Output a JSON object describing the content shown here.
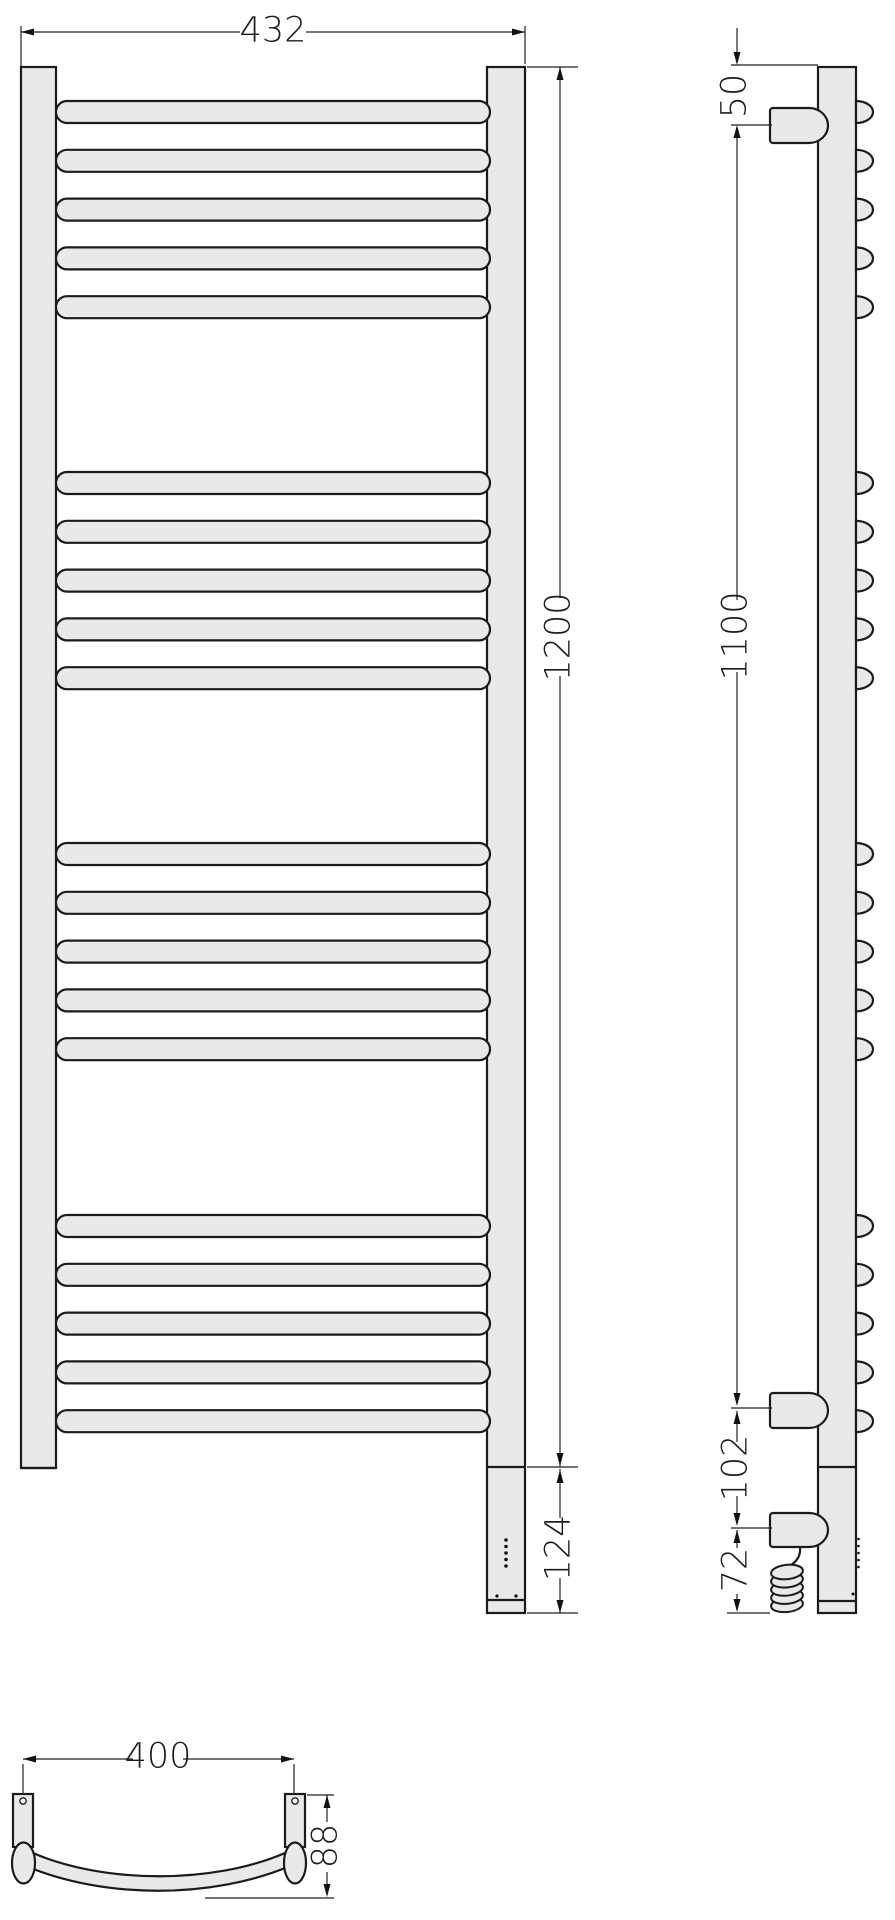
{
  "drawing": {
    "kind": "technical-dimension-drawing",
    "subject": "curved ladder towel rail with electric heating element, three orthographic views",
    "colors": {
      "fill": "#e9e9e9",
      "outline": "#1b1b1b",
      "dim_line": "#222222",
      "background": "#ffffff"
    }
  },
  "dimensions": {
    "front_width": {
      "value": "432"
    },
    "front_height": {
      "value": "1200"
    },
    "heater_section": {
      "value": "124"
    },
    "side_top_offset": {
      "value": "50"
    },
    "side_bracket_span": {
      "value": "1100"
    },
    "side_lower_offset": {
      "value": "102"
    },
    "side_bottom_offset": {
      "value": "72"
    },
    "top_mount_spacing": {
      "value": "400"
    },
    "top_depth": {
      "value": "88"
    }
  },
  "geometry": {
    "front": {
      "left_post": {
        "x": 21,
        "y": 67,
        "w": 35,
        "h": 1401
      },
      "right_post": {
        "x": 487,
        "y": 67,
        "w": 38,
        "h": 1546
      },
      "bar_x": 56,
      "bar_w": 434,
      "bar_h": 22,
      "bar_group_starts": [
        101,
        472,
        843,
        1215
      ],
      "bars_per_group": 5,
      "bar_pitch": 48.8,
      "divider_y": 1467,
      "cap_y": 1600,
      "bottom_y": 1613,
      "led_count": 5,
      "led_x": 506,
      "led_y0": 1540,
      "led_dy": 6.5,
      "screw_dots": [
        [
          497,
          1596
        ],
        [
          516,
          1596
        ]
      ]
    },
    "side": {
      "post": {
        "x": 818,
        "y": 67,
        "w": 38,
        "h": 1546
      },
      "bump_rx": 17,
      "divider_y": 1467,
      "cap_y": 1601,
      "brackets_y": [
        108,
        1393
      ],
      "bracket_h": 35,
      "cable_housing_y": 1513,
      "cable_housing_h": 34,
      "coil": {
        "cx": 787,
        "cy0": 1572,
        "dy": 8.2,
        "loops": 5,
        "rx": 16,
        "ry": 7.2
      },
      "led_count": 5,
      "led_x": 858.5,
      "led_y0": 1539,
      "led_dy": 7,
      "screw_dot": [
        853,
        1594
      ]
    },
    "top": {
      "left_block": {
        "x": 13,
        "y": 1794,
        "w": 20,
        "h": 53
      },
      "right_block": {
        "x": 285,
        "y": 1794,
        "w": 20,
        "h": 53
      },
      "holes": [
        [
          23,
          1801
        ],
        [
          295,
          1801
        ]
      ],
      "ellipses": [
        [
          23.5,
          1863,
          11.5,
          20.5
        ],
        [
          295,
          1863,
          11,
          20.5
        ]
      ]
    }
  }
}
